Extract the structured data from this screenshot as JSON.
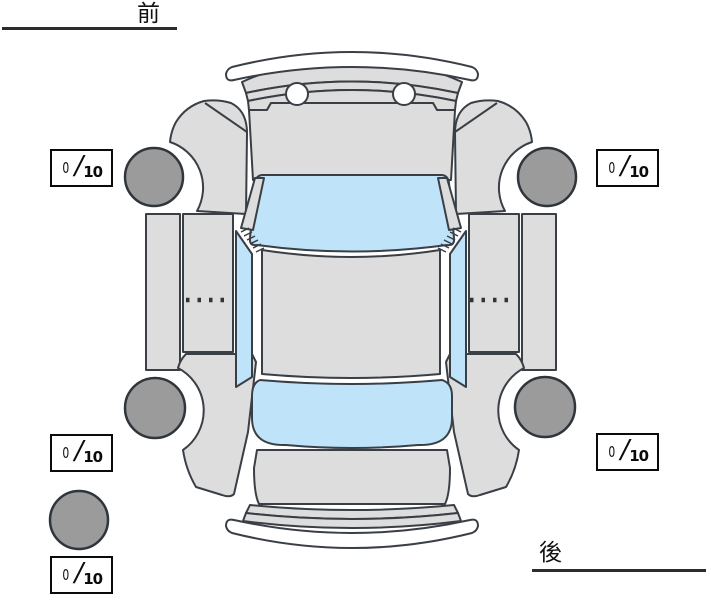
{
  "labels": {
    "front": "前",
    "rear": "後"
  },
  "diagram": {
    "name": "vehicle-condition-expanded-view",
    "description": "top-down expanded (unfolded) car body diagram with tire tread score boxes",
    "colors": {
      "background": "#ffffff",
      "body_panel": "#dcdddc",
      "glass": "#bfe4f9",
      "tire": "#9b9b9b",
      "outline": "#3a3f46",
      "score_border": "#0b0b0b",
      "underline": "#2c2c2c"
    },
    "tire_positions": [
      "front-left",
      "front-right",
      "rear-left",
      "rear-right",
      "spare"
    ]
  },
  "tread_scores": {
    "front_left": {
      "value": "0",
      "separator": "/",
      "max": "10"
    },
    "front_right": {
      "value": "0",
      "separator": "/",
      "max": "10"
    },
    "rear_left": {
      "value": "0",
      "separator": "/",
      "max": "10"
    },
    "rear_right": {
      "value": "0",
      "separator": "/",
      "max": "10"
    },
    "spare": {
      "value": "0",
      "separator": "/",
      "max": "10"
    }
  }
}
